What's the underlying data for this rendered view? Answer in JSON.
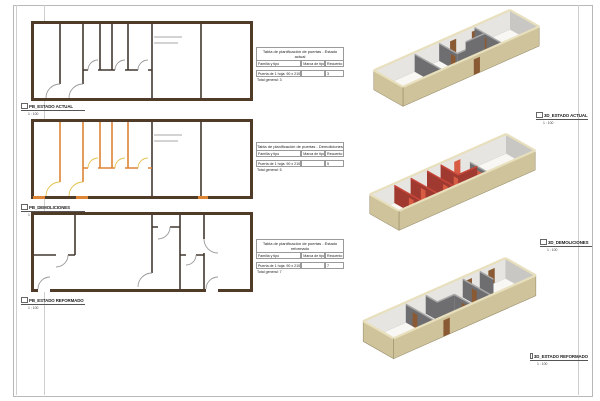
{
  "sheet": {
    "type": "architectural-sheet"
  },
  "colors": {
    "plan_wall_brown": "#4f3b28",
    "plan_partition": "#423930",
    "demolition_orange": "#dd8435",
    "demolition_door_yellow": "#e5c14c",
    "exterior_tan": "#cfc39c",
    "interior_gray": "#6e6e71",
    "door_brown": "#8a5a34",
    "demolition_red": "#a03a31",
    "demolition_red_bright": "#d85c43"
  },
  "plans": [
    {
      "title": "PB_ESTADO ACTUAL",
      "scale": "1 : 100"
    },
    {
      "title": "PB_DEMOLICIONES",
      "scale": "1 : 100"
    },
    {
      "title": "PB_ESTADO REFORMADO",
      "scale": "1 : 100"
    }
  ],
  "views3d": [
    {
      "title": "3D_ESTADO ACTUAL",
      "scale": "1 : 100"
    },
    {
      "title": "3D_DEMOLICIONES",
      "scale": "1 : 100"
    },
    {
      "title": "3D_ESTADO REFORMADO",
      "scale": "1 : 100"
    }
  ],
  "schedules": [
    {
      "title": "Tabla de planificación de puertas - Estado actual",
      "columns": [
        "Familia y tipo",
        "Marca de tipo",
        "Recuento"
      ],
      "rows": [
        [
          "Puerta de 1 hoja: 90 x 210 cm",
          "",
          "3"
        ]
      ],
      "total": "Total general: 3"
    },
    {
      "title": "Tabla de planificación de puertas - Demoliciones",
      "columns": [
        "Familia y tipo",
        "Marca de tipo",
        "Recuento"
      ],
      "rows": [
        [
          "Puerta de 1 hoja: 90 x 210 cm",
          "",
          "5"
        ]
      ],
      "total": "Total general: 5"
    },
    {
      "title": "Tabla de planificación de puertas - Estado reformado",
      "columns": [
        "Familia y tipo",
        "Marca de tipo",
        "Recuento"
      ],
      "rows": [
        [
          "Puerta de 1 hoja: 90 x 210 cm",
          "",
          "7"
        ]
      ],
      "total": "Total general: 7"
    }
  ]
}
